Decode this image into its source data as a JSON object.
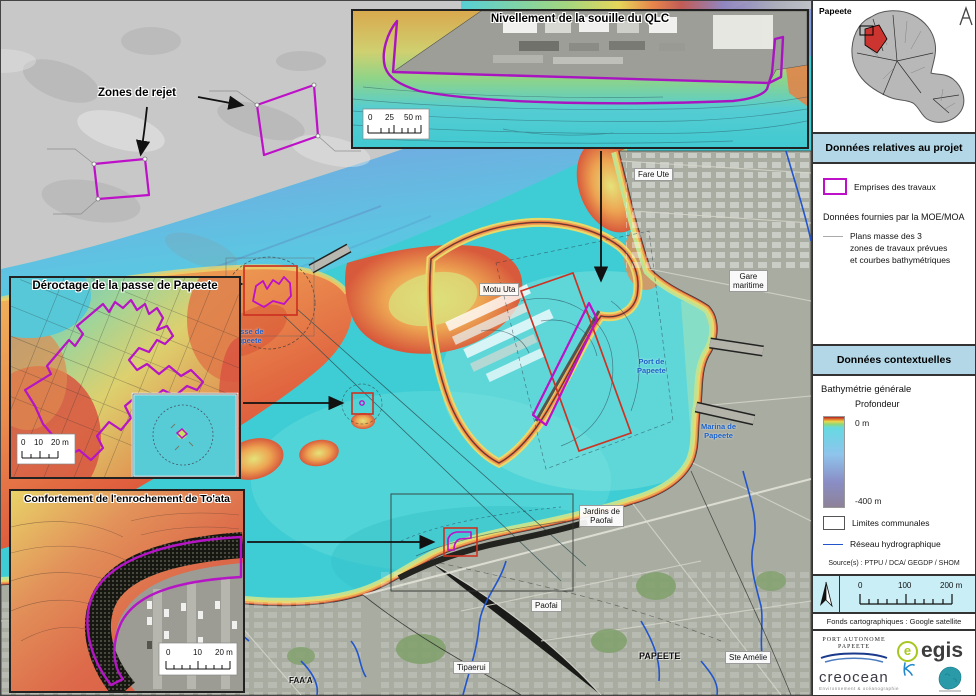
{
  "map": {
    "labels": {
      "zones_rejet": "Zones de rejet",
      "fare_ute": "Fare Ute",
      "motu_uta": "Motu Uta",
      "gare_l1": "Gare",
      "gare_l2": "maritime",
      "port_l1": "Port de",
      "port_l2": "Papeete",
      "marina_l1": "Marina de",
      "marina_l2": "Papeete",
      "passe_l1": "Passe de",
      "passe_l2": "Papeete",
      "jardins_l1": "Jardins de",
      "jardins_l2": "Paofai",
      "paofai": "Paofai",
      "papeete_city": "PAPEETE",
      "ste_amelie": "Ste Amélie",
      "tipaerui": "Tipaerui",
      "faaa": "FAA'A"
    }
  },
  "insets": {
    "qlc": {
      "title": "Nivellement de la souille du QLC",
      "scale_ticks": [
        "0",
        "25",
        "50 m"
      ]
    },
    "passe": {
      "title": "Déroctage de la passe de Papeete",
      "scale_ticks": [
        "0",
        "10",
        "20 m"
      ]
    },
    "toata": {
      "title": "Confortement de l'enrochement de To'ata",
      "scale_ticks": [
        "0",
        "10",
        "20 m"
      ]
    }
  },
  "panel": {
    "island_label": "Papeete",
    "project": {
      "header": "Données relatives au projet",
      "emprises_label": "Emprises des travaux",
      "fournies_label": "Données fournies par la MOE/MOA",
      "plans_lines": [
        "Plans masse des 3",
        "zones de travaux prévues",
        "et courbes  bathymétriques"
      ]
    },
    "context": {
      "header": "Données contextuelles",
      "bathy_title": "Bathymétrie générale",
      "profondeur_label": "Profondeur",
      "depth_top": "0 m",
      "depth_bottom": "-400 m",
      "limites_label": "Limites communales",
      "reseau_label": "Réseau hydrographique",
      "sources": "Source(s) : PTPU / DCA/ GEGDP / SHOM"
    },
    "scalebar": {
      "ticks": [
        "0",
        "100",
        "200 m"
      ]
    },
    "fonds": "Fonds cartographiques : Google satellite",
    "logos": {
      "port_line1": "PORT AUTONOME",
      "port_line2": "PAPEETE",
      "egis": "egis",
      "egis_e": "e",
      "creocean": "creocean",
      "creocean_sub": "Environnement & océanographie"
    }
  },
  "colors": {
    "works_outline_magenta": "#bd10c8",
    "extent_red": "#cc3322",
    "panel_header_blue": "#b3d7e6",
    "scalebar_bg": "#c9eef6",
    "water_label_blue": "#1a5fc8",
    "hydro_blue": "#2255cc",
    "commune_red": "#cc3430"
  }
}
